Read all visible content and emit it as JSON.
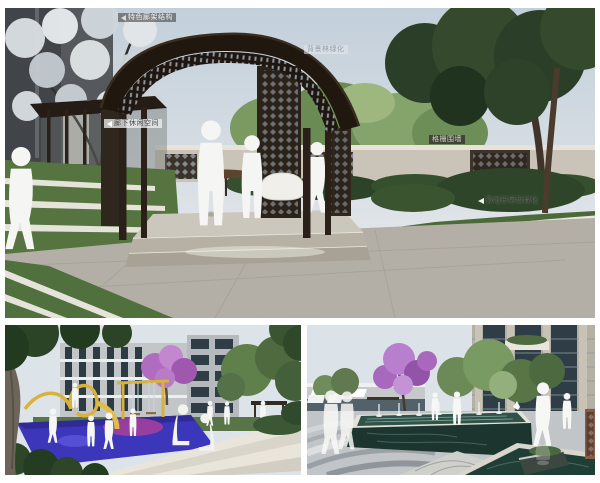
{
  "page": {
    "background": "#ffffff"
  },
  "panels": {
    "top": {
      "labels": [
        {
          "text": "特色廊架结构"
        },
        {
          "text": "廊下休闲空间"
        },
        {
          "text": "背景林绿化"
        },
        {
          "text": "格栅围墙"
        },
        {
          "text": "微地形层级绿化"
        }
      ]
    },
    "bottom_left": {
      "labels": []
    },
    "bottom_right": {
      "labels": []
    }
  },
  "colors": {
    "sky": "#c9d4de",
    "lawn": "#4e6c3a",
    "pergola_wood": "#241b14",
    "paving": "#b4afa6",
    "curb_white": "#e9e6dd",
    "playground_blue": "#3b36ba",
    "playground_magenta": "#a23f9e",
    "play_tube_yellow": "#d8b23c",
    "pool_water": "#2f5348",
    "pool_marble": "#1c362f",
    "blossom_purple": "#b077c4",
    "silhouette": "#f5f5f3"
  }
}
